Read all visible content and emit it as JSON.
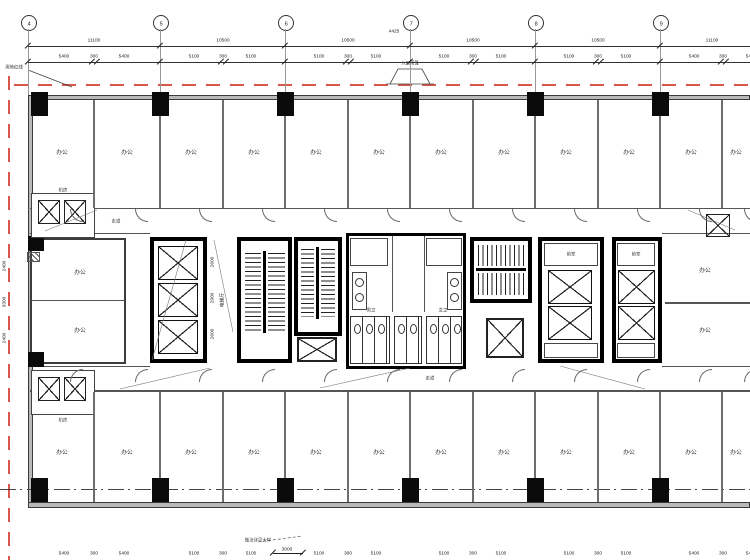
{
  "grid": {
    "bubble_labels": [
      "4",
      "5",
      "6",
      "7",
      "8",
      "9"
    ]
  },
  "dims": {
    "near_bubble_note": "4425",
    "tier1": [
      "11100",
      "10500",
      "10500",
      "10500",
      "10500",
      "11100"
    ],
    "tier2": [
      [
        "5400",
        "300",
        "5400"
      ],
      [
        "5100",
        "300",
        "5100"
      ],
      [
        "5100",
        "300",
        "5100"
      ],
      [
        "5100",
        "300",
        "5100"
      ],
      [
        "5100",
        "300",
        "5100"
      ],
      [
        "5400",
        "300",
        "5400"
      ]
    ],
    "left": [
      "2400",
      "3300",
      "2400"
    ],
    "lobby": [
      "2600",
      "2900",
      "2600"
    ]
  },
  "labels": {
    "office": "办公",
    "corridor": "走道",
    "elevator_hall": "电梯厅",
    "vestibule": "前室",
    "wc_male": "男卫",
    "wc_female": "女卫",
    "equipment": "机房",
    "site_line": "用地红线",
    "canopy": "入口雨篷",
    "bottom_note": "做法详见大样",
    "bottom_note_dim": "3000"
  },
  "colors": {
    "red_line": "#d9574a",
    "wall_gray": "#555555",
    "core_black": "#0b0b0b"
  }
}
